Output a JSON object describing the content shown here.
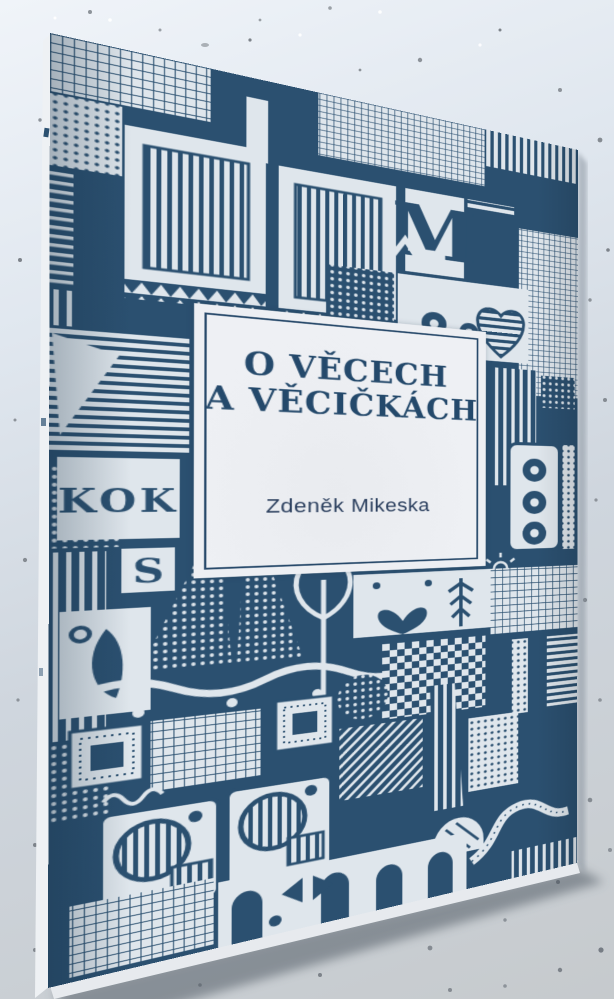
{
  "cover": {
    "title_line1": "O VĚCECH",
    "title_line2": "A VĚCIČKÁCH",
    "author": "Zdeněk Mikeska",
    "art_letters": {
      "m": "M",
      "kok": "KOK",
      "s": "S"
    },
    "colors": {
      "ink_navy": "#2b5070",
      "pattern_paper": "#dfe6ec",
      "panel_paper": "#edeff3",
      "title_text": "#24496b",
      "background_top": "#f0f4f9",
      "background_bottom": "#c6cacd"
    }
  }
}
